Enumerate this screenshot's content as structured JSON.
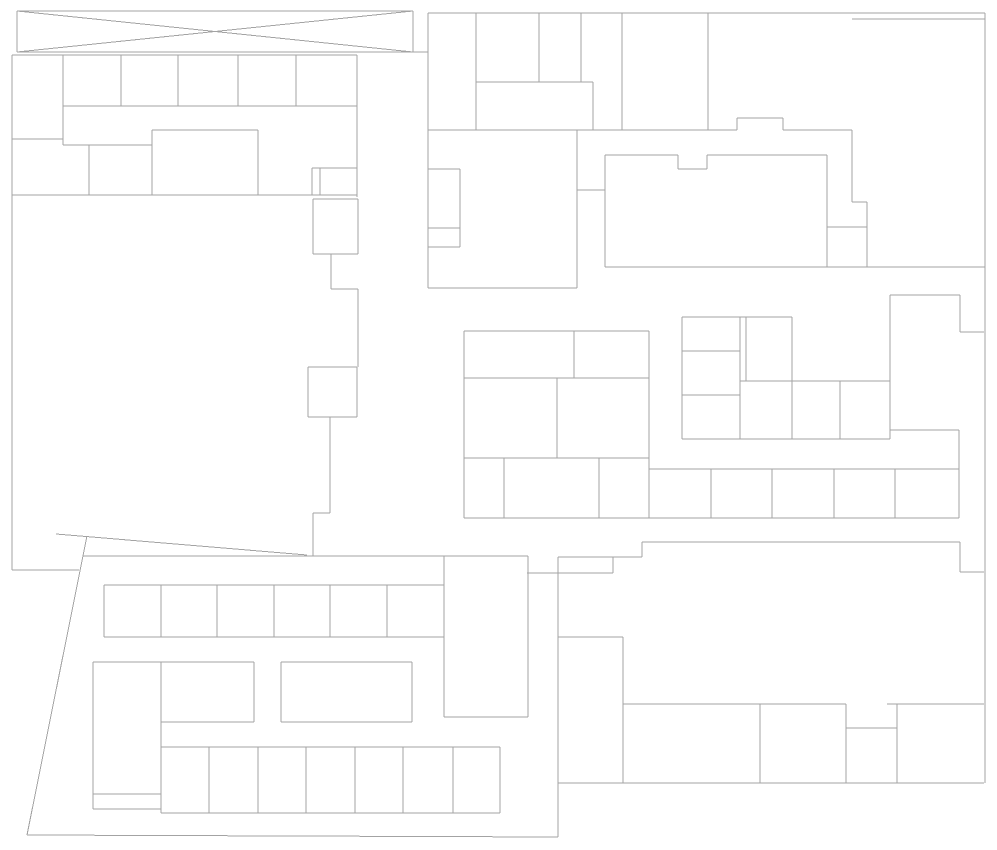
{
  "canvas": {
    "width": 997,
    "height": 850,
    "background_color": "#ffffff",
    "stroke_color": "#a3a3a3",
    "stroke_width": 1
  },
  "drawing": {
    "description": "architectural-floor-plan-line-drawing",
    "groups": [
      {
        "name": "crossed-box-top-left",
        "segments": [
          [
            17,
            11,
            413,
            11
          ],
          [
            17,
            52,
            413,
            52
          ],
          [
            17,
            11,
            17,
            52
          ],
          [
            413,
            11,
            413,
            52
          ],
          [
            17,
            11,
            413,
            52
          ],
          [
            17,
            52,
            413,
            11
          ],
          [
            413,
            52,
            428,
            52
          ]
        ]
      },
      {
        "name": "building-top-left",
        "segments": [
          [
            12,
            55,
            357,
            55
          ],
          [
            12,
            55,
            12,
            570
          ],
          [
            63,
            55,
            63,
            145
          ],
          [
            121,
            55,
            121,
            106
          ],
          [
            178,
            55,
            178,
            106
          ],
          [
            238,
            55,
            238,
            106
          ],
          [
            296,
            55,
            296,
            106
          ],
          [
            357,
            55,
            357,
            197
          ],
          [
            63,
            106,
            357,
            106
          ],
          [
            12,
            139,
            63,
            139
          ],
          [
            63,
            145,
            152,
            145
          ],
          [
            89,
            145,
            89,
            195
          ],
          [
            152,
            130,
            152,
            195
          ],
          [
            152,
            130,
            258,
            130
          ],
          [
            258,
            130,
            258,
            195
          ],
          [
            12,
            195,
            357,
            195
          ],
          [
            312,
            168,
            357,
            168
          ],
          [
            312,
            168,
            312,
            195
          ],
          [
            320,
            168,
            320,
            195
          ],
          [
            12,
            570,
            79,
            570
          ]
        ]
      },
      {
        "name": "corridor-left",
        "segments": [
          [
            313,
            199,
            358,
            199
          ],
          [
            313,
            199,
            313,
            254
          ],
          [
            358,
            199,
            358,
            254
          ],
          [
            313,
            254,
            358,
            254
          ],
          [
            331,
            254,
            331,
            289
          ],
          [
            331,
            289,
            358,
            289
          ],
          [
            358,
            289,
            358,
            367
          ],
          [
            308,
            367,
            357,
            367
          ],
          [
            308,
            367,
            308,
            417
          ],
          [
            357,
            367,
            357,
            417
          ],
          [
            308,
            417,
            357,
            417
          ],
          [
            330,
            417,
            330,
            513
          ],
          [
            313,
            513,
            330,
            513
          ],
          [
            313,
            513,
            313,
            556
          ]
        ]
      },
      {
        "name": "building-top-middle",
        "segments": [
          [
            428,
            13,
            985,
            13
          ],
          [
            428,
            13,
            428,
            288
          ],
          [
            476,
            13,
            476,
            130
          ],
          [
            539,
            13,
            539,
            82
          ],
          [
            581,
            13,
            581,
            82
          ],
          [
            476,
            82,
            593,
            82
          ],
          [
            593,
            82,
            593,
            130
          ],
          [
            622,
            13,
            622,
            130
          ],
          [
            428,
            130,
            737,
            130
          ],
          [
            737,
            118,
            737,
            130
          ],
          [
            737,
            118,
            783,
            118
          ],
          [
            783,
            118,
            783,
            130
          ],
          [
            783,
            130,
            852,
            130
          ],
          [
            708,
            13,
            708,
            130
          ],
          [
            428,
            169,
            460,
            169
          ],
          [
            428,
            228,
            460,
            228
          ],
          [
            428,
            247,
            460,
            247
          ],
          [
            460,
            169,
            460,
            247
          ],
          [
            428,
            288,
            577,
            288
          ],
          [
            577,
            130,
            577,
            288
          ],
          [
            577,
            190,
            605,
            190
          ]
        ]
      },
      {
        "name": "building-top-right",
        "segments": [
          [
            852,
            19,
            985,
            19
          ],
          [
            985,
            13,
            985,
            783
          ],
          [
            852,
            130,
            852,
            202
          ],
          [
            852,
            202,
            867,
            202
          ],
          [
            867,
            202,
            867,
            267
          ],
          [
            827,
            227,
            867,
            227
          ],
          [
            827,
            155,
            827,
            267
          ],
          [
            605,
            155,
            678,
            155
          ],
          [
            678,
            155,
            678,
            169
          ],
          [
            678,
            169,
            707,
            169
          ],
          [
            707,
            155,
            707,
            169
          ],
          [
            707,
            155,
            827,
            155
          ],
          [
            605,
            155,
            605,
            267
          ],
          [
            605,
            267,
            985,
            267
          ]
        ]
      },
      {
        "name": "cluster-middle",
        "segments": [
          [
            464,
            331,
            649,
            331
          ],
          [
            464,
            331,
            464,
            518
          ],
          [
            574,
            331,
            574,
            378
          ],
          [
            464,
            378,
            649,
            378
          ],
          [
            649,
            331,
            649,
            518
          ],
          [
            557,
            378,
            557,
            458
          ],
          [
            464,
            458,
            649,
            458
          ],
          [
            504,
            458,
            504,
            518
          ],
          [
            599,
            458,
            599,
            518
          ],
          [
            464,
            518,
            959,
            518
          ],
          [
            649,
            469,
            959,
            469
          ],
          [
            711,
            469,
            711,
            518
          ],
          [
            772,
            469,
            772,
            518
          ],
          [
            834,
            469,
            834,
            518
          ],
          [
            895,
            469,
            895,
            518
          ],
          [
            682,
            317,
            792,
            317
          ],
          [
            682,
            317,
            682,
            439
          ],
          [
            740,
            317,
            740,
            439
          ],
          [
            746,
            317,
            746,
            381
          ],
          [
            792,
            317,
            792,
            439
          ],
          [
            682,
            351,
            740,
            351
          ],
          [
            682,
            395,
            740,
            395
          ],
          [
            740,
            381,
            890,
            381
          ],
          [
            840,
            381,
            840,
            439
          ],
          [
            682,
            439,
            890,
            439
          ],
          [
            890,
            295,
            890,
            439
          ],
          [
            890,
            295,
            960,
            295
          ],
          [
            960,
            295,
            960,
            332
          ],
          [
            960,
            332,
            984,
            332
          ],
          [
            890,
            430,
            959,
            430
          ],
          [
            959,
            430,
            959,
            518
          ]
        ]
      },
      {
        "name": "building-bottom-right",
        "segments": [
          [
            642,
            542,
            960,
            542
          ],
          [
            960,
            542,
            960,
            572
          ],
          [
            960,
            572,
            984,
            572
          ],
          [
            642,
            542,
            642,
            557
          ],
          [
            558,
            557,
            642,
            557
          ],
          [
            613,
            557,
            613,
            573
          ],
          [
            527,
            573,
            613,
            573
          ],
          [
            558,
            557,
            558,
            837
          ],
          [
            558,
            637,
            623,
            637
          ],
          [
            623,
            637,
            623,
            783
          ],
          [
            623,
            704,
            846,
            704
          ],
          [
            760,
            704,
            760,
            783
          ],
          [
            846,
            704,
            846,
            783
          ],
          [
            846,
            728,
            897,
            728
          ],
          [
            897,
            704,
            897,
            783
          ],
          [
            887,
            704,
            984,
            704
          ],
          [
            558,
            783,
            984,
            783
          ]
        ]
      },
      {
        "name": "building-bottom-left",
        "segments": [
          [
            56,
            534,
            307,
            555
          ],
          [
            87,
            536,
            27,
            835
          ],
          [
            83,
            556,
            528,
            556
          ],
          [
            27,
            835,
            558,
            837
          ],
          [
            104,
            585,
            444,
            585
          ],
          [
            104,
            637,
            444,
            637
          ],
          [
            104,
            585,
            104,
            637
          ],
          [
            161,
            585,
            161,
            637
          ],
          [
            217,
            585,
            217,
            637
          ],
          [
            274,
            585,
            274,
            637
          ],
          [
            330,
            585,
            330,
            637
          ],
          [
            387,
            585,
            387,
            637
          ],
          [
            444,
            556,
            444,
            717
          ],
          [
            528,
            556,
            528,
            717
          ],
          [
            444,
            717,
            528,
            717
          ],
          [
            93,
            662,
            254,
            662
          ],
          [
            93,
            662,
            93,
            809
          ],
          [
            161,
            662,
            161,
            813
          ],
          [
            93,
            794,
            161,
            794
          ],
          [
            93,
            809,
            161,
            809
          ],
          [
            161,
            722,
            254,
            722
          ],
          [
            254,
            662,
            254,
            722
          ],
          [
            281,
            662,
            412,
            662
          ],
          [
            281,
            662,
            281,
            722
          ],
          [
            412,
            662,
            412,
            722
          ],
          [
            281,
            722,
            412,
            722
          ],
          [
            161,
            747,
            500,
            747
          ],
          [
            161,
            813,
            500,
            813
          ],
          [
            209,
            747,
            209,
            813
          ],
          [
            258,
            747,
            258,
            813
          ],
          [
            306,
            747,
            306,
            813
          ],
          [
            355,
            747,
            355,
            813
          ],
          [
            403,
            747,
            403,
            813
          ],
          [
            453,
            747,
            453,
            813
          ],
          [
            500,
            747,
            500,
            813
          ]
        ]
      }
    ]
  }
}
